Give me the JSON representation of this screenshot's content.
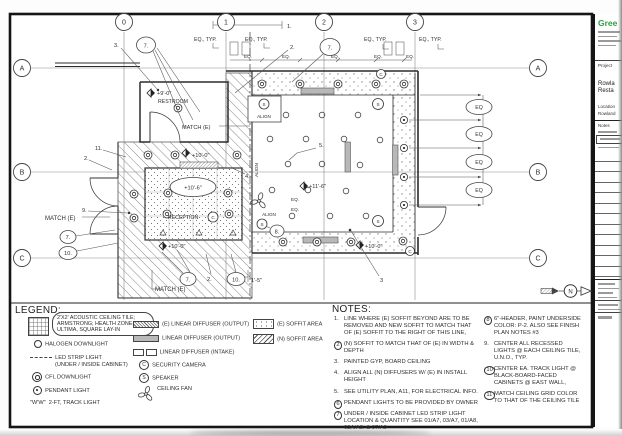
{
  "plan": {
    "grid": {
      "cols": [
        "0",
        "1",
        "2",
        "3"
      ],
      "rows": [
        "A",
        "B",
        "C"
      ]
    },
    "labels": {
      "eq_typ": "EQ., TYP.",
      "eq": "EQ.",
      "eq_c": "EQ",
      "match_e": "MATCH (E)",
      "align": "ALIGN",
      "restroom": "RESTROOM",
      "reception": "RECEPTION",
      "dim15": "1'-5\"",
      "s": "S",
      "c": "C"
    },
    "elevations": {
      "e9": "+9'-0\"",
      "e10": "+10'-0\"",
      "e106": "+10'-6\"",
      "e116": "+11'-6\""
    },
    "callouts": {
      "n1": "1.",
      "n2": "2.",
      "n3": "3.",
      "n3p": "3",
      "n4": "4.",
      "n5": "5.",
      "n7": "7.",
      "n8": "8.",
      "n9": "9.",
      "n10": "10.",
      "n11": "11."
    }
  },
  "legend": {
    "title": "LEGEND:",
    "tile1": "2'X2' ACOUSTIC CEILING TILE;",
    "tile2": "ARMSTRONG; HEALTH ZONE-",
    "tile3": "ULTIMA, SQUARE LAY-IN",
    "halogen": "HALOGEN DOWNLIGHT",
    "led1": "LED STRIP LIGHT",
    "led2": "(UNDER / INSIDE CABINET)",
    "cfl": "CFL DOWNLIGHT",
    "pendant": "PENDANT LIGHT",
    "track_sym": "\"W'W\"",
    "track": "2-FT, TRACK LIGHT",
    "diff_e": "(E) LINEAR DIFFUSER (OUTPUT)",
    "diff_out": "LINEAR DIFFUSER (OUTPUT)",
    "diff_in": "LINEAR DIFFUSER (INTAKE)",
    "cam": "SECURITY CAMERA",
    "spk": "SPEAKER",
    "fan": "CEILING FAN",
    "soffit_e": "(E) SOFFIT AREA",
    "soffit_n": "(N) SOFFIT AREA",
    "c": "C",
    "s": "S"
  },
  "notes": {
    "title": "NOTES:",
    "left": [
      {
        "num": "1.",
        "text": "LINE WHERE (E) SOFFIT BEYOND ARE TO BE REMOVED AND NEW SOFFIT TO MATCH THAT OF (E) SOFFIT TO THE RIGHT OF THIS LINE,"
      },
      {
        "num": "2",
        "text": "(N) SOFFIT TO MATCH THAT OF (E) IN WIDTH & DEPTH"
      },
      {
        "num": "3.",
        "text": "PAINTED GYP, BOARD CEILING"
      },
      {
        "num": "4.",
        "text": "ALIGN ALL (N) DIFFUSERS W/ (E) IN INSTALL HEIGHT"
      },
      {
        "num": "5.",
        "text": "SEE UTILITY PLAN, A11, FOR ELECTRICAL INFO."
      },
      {
        "num": "6",
        "text": "PENDANT LIGHTS TO BE PROVIDED BY OWNER"
      },
      {
        "num": "7",
        "text": "UNDER / INSIDE CABINET LED STRIP LIGHT LOCATION & QUANTITY SEE 01/A7, 03/A7, 01/A8, 02A/A8, & 07/A9"
      }
    ],
    "right": [
      {
        "num": "8",
        "text": "6\"-HEADER, PAINT UNDERSIDE COLOR: P-2. ALSO SEE FINISH PLAN NOTES #3"
      },
      {
        "num": "9.",
        "text": "CENTER ALL RECESSED LIGHTS @ EACH CEILING TILE, U.N.O., TYP."
      },
      {
        "num": "10",
        "text": "CENTER EA. TRACK LIGHT @ BLACK-BOARD-FACED CABINETS @ EAST WALL,"
      },
      {
        "num": "11",
        "text": "MATCH CEILING GRID COLOR TO THAT OF THE CEILING TILE"
      }
    ]
  },
  "titleblock": {
    "logo": "Gree",
    "logo_color": "#2f9e41",
    "project_label": "Project",
    "project_name_1": "Rowla",
    "project_name_2": "Resta",
    "location_label": "Location",
    "location_value": "Rowland",
    "notes_label": "Notes"
  },
  "north": {
    "label": "N"
  }
}
